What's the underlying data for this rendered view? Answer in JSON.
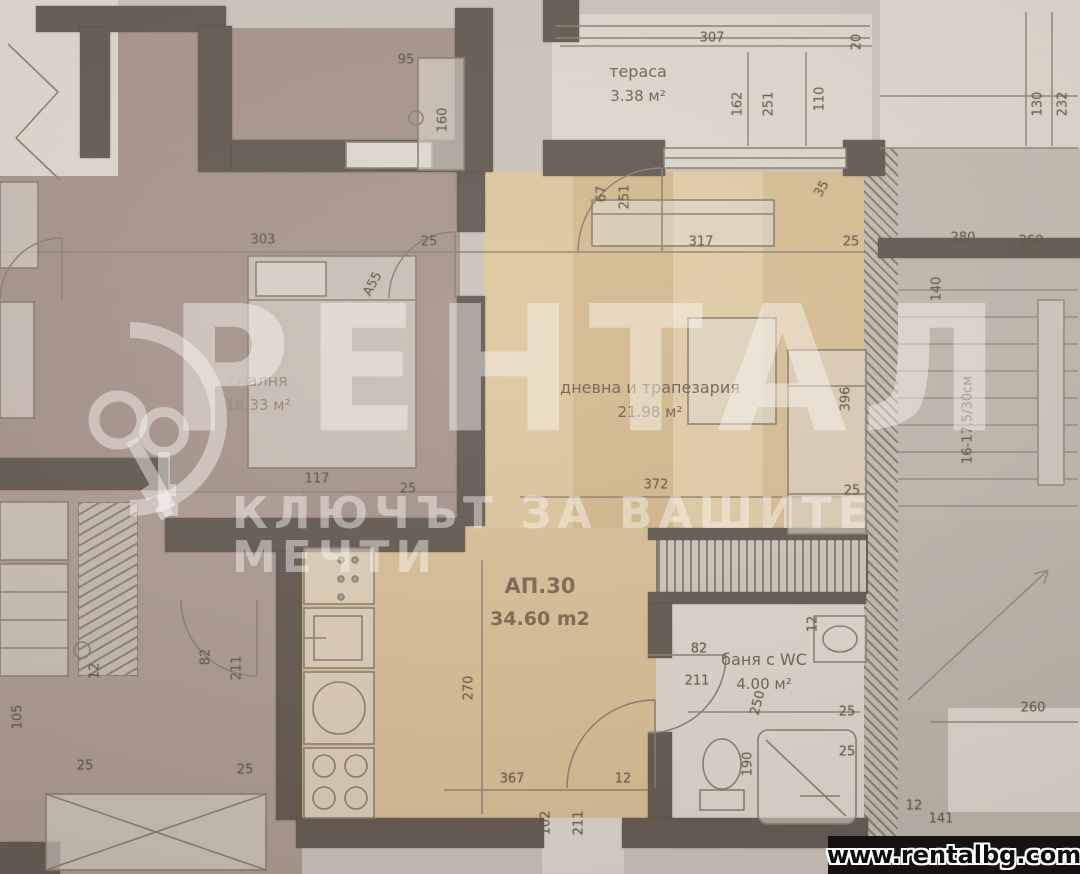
{
  "site": {
    "url": "www.rentalbg.com"
  },
  "watermark": {
    "brand": "РЕНТАЛ",
    "tagline": "КЛЮЧЪТ ЗА ВАШИТЕ МЕЧТИ",
    "logo": "keys-emblem"
  },
  "plan": {
    "apartment": {
      "id": "АП.30",
      "area": "34.60 m2"
    },
    "rooms": [
      {
        "key": "terrace",
        "label": "тераса",
        "area": "3.38 м²",
        "x": 638,
        "y": 84
      },
      {
        "key": "bedroom",
        "label": "спалня",
        "area": "18.33 м²",
        "x": 258,
        "y": 393
      },
      {
        "key": "living-dining",
        "label": "дневна и трапезария",
        "area": "21.98 м²",
        "x": 650,
        "y": 400
      },
      {
        "key": "bathroom",
        "label": "баня с WC",
        "area": "4.00 м²",
        "x": 764,
        "y": 672
      }
    ],
    "dimensions": [
      {
        "t": "307",
        "x": 712,
        "y": 38,
        "r": 0
      },
      {
        "t": "20",
        "x": 857,
        "y": 42,
        "r": -90
      },
      {
        "t": "162",
        "x": 738,
        "y": 104,
        "r": -90
      },
      {
        "t": "251",
        "x": 769,
        "y": 104,
        "r": -90
      },
      {
        "t": "110",
        "x": 820,
        "y": 99,
        "r": -90
      },
      {
        "t": "130",
        "x": 1038,
        "y": 104,
        "r": -90
      },
      {
        "t": "232",
        "x": 1063,
        "y": 104,
        "r": -90
      },
      {
        "t": "95",
        "x": 406,
        "y": 60,
        "r": 0
      },
      {
        "t": "160",
        "x": 443,
        "y": 120,
        "r": -90
      },
      {
        "t": "67",
        "x": 602,
        "y": 194,
        "r": -90
      },
      {
        "t": "251",
        "x": 625,
        "y": 197,
        "r": -90
      },
      {
        "t": "317",
        "x": 701,
        "y": 242,
        "r": 0
      },
      {
        "t": "25",
        "x": 851,
        "y": 242,
        "r": 0
      },
      {
        "t": "35",
        "x": 822,
        "y": 189,
        "r": -60
      },
      {
        "t": "280",
        "x": 963,
        "y": 238,
        "r": 0
      },
      {
        "t": "260",
        "x": 1031,
        "y": 241,
        "r": 0
      },
      {
        "t": "140",
        "x": 937,
        "y": 289,
        "r": -90
      },
      {
        "t": "16-17.5/30см",
        "x": 968,
        "y": 420,
        "r": -90
      },
      {
        "t": "303",
        "x": 263,
        "y": 240,
        "r": 0
      },
      {
        "t": "25",
        "x": 429,
        "y": 242,
        "r": 0
      },
      {
        "t": "A55",
        "x": 373,
        "y": 284,
        "r": -62
      },
      {
        "t": "117",
        "x": 317,
        "y": 479,
        "r": 0
      },
      {
        "t": "25",
        "x": 408,
        "y": 489,
        "r": 0
      },
      {
        "t": "396",
        "x": 846,
        "y": 399,
        "r": -90
      },
      {
        "t": "372",
        "x": 656,
        "y": 485,
        "r": 0
      },
      {
        "t": "25",
        "x": 852,
        "y": 491,
        "r": 0
      },
      {
        "t": "82",
        "x": 699,
        "y": 649,
        "r": 0
      },
      {
        "t": "211",
        "x": 697,
        "y": 681,
        "r": 0
      },
      {
        "t": "12",
        "x": 813,
        "y": 624,
        "r": -90
      },
      {
        "t": "270",
        "x": 469,
        "y": 688,
        "r": -90
      },
      {
        "t": "367",
        "x": 512,
        "y": 779,
        "r": 0
      },
      {
        "t": "12",
        "x": 623,
        "y": 779,
        "r": 0
      },
      {
        "t": "102",
        "x": 546,
        "y": 823,
        "r": -90
      },
      {
        "t": "211",
        "x": 579,
        "y": 823,
        "r": -90
      },
      {
        "t": "250",
        "x": 758,
        "y": 703,
        "r": -75
      },
      {
        "t": "25",
        "x": 847,
        "y": 712,
        "r": 0
      },
      {
        "t": "190",
        "x": 748,
        "y": 764,
        "r": -90
      },
      {
        "t": "25",
        "x": 847,
        "y": 752,
        "r": 0
      },
      {
        "t": "82",
        "x": 206,
        "y": 657,
        "r": -90
      },
      {
        "t": "211",
        "x": 237,
        "y": 668,
        "r": -90
      },
      {
        "t": "12",
        "x": 95,
        "y": 671,
        "r": -90
      },
      {
        "t": "105",
        "x": 18,
        "y": 717,
        "r": -90
      },
      {
        "t": "25",
        "x": 85,
        "y": 766,
        "r": 0
      },
      {
        "t": "25",
        "x": 245,
        "y": 770,
        "r": 0
      },
      {
        "t": "260",
        "x": 1033,
        "y": 708,
        "r": 0
      },
      {
        "t": "12",
        "x": 914,
        "y": 806,
        "r": 0
      },
      {
        "t": "141",
        "x": 941,
        "y": 819,
        "r": 0
      }
    ]
  },
  "colors": {
    "paper": "#d5cec6",
    "mauve": "#ab9a92",
    "beige": "#e4cb9e",
    "white_room": "#e9e5dd",
    "stair": "#c9c2b9",
    "wall": "#5f5750",
    "watermark": "rgba(250,247,242,0.46)",
    "bar": "#161210"
  }
}
